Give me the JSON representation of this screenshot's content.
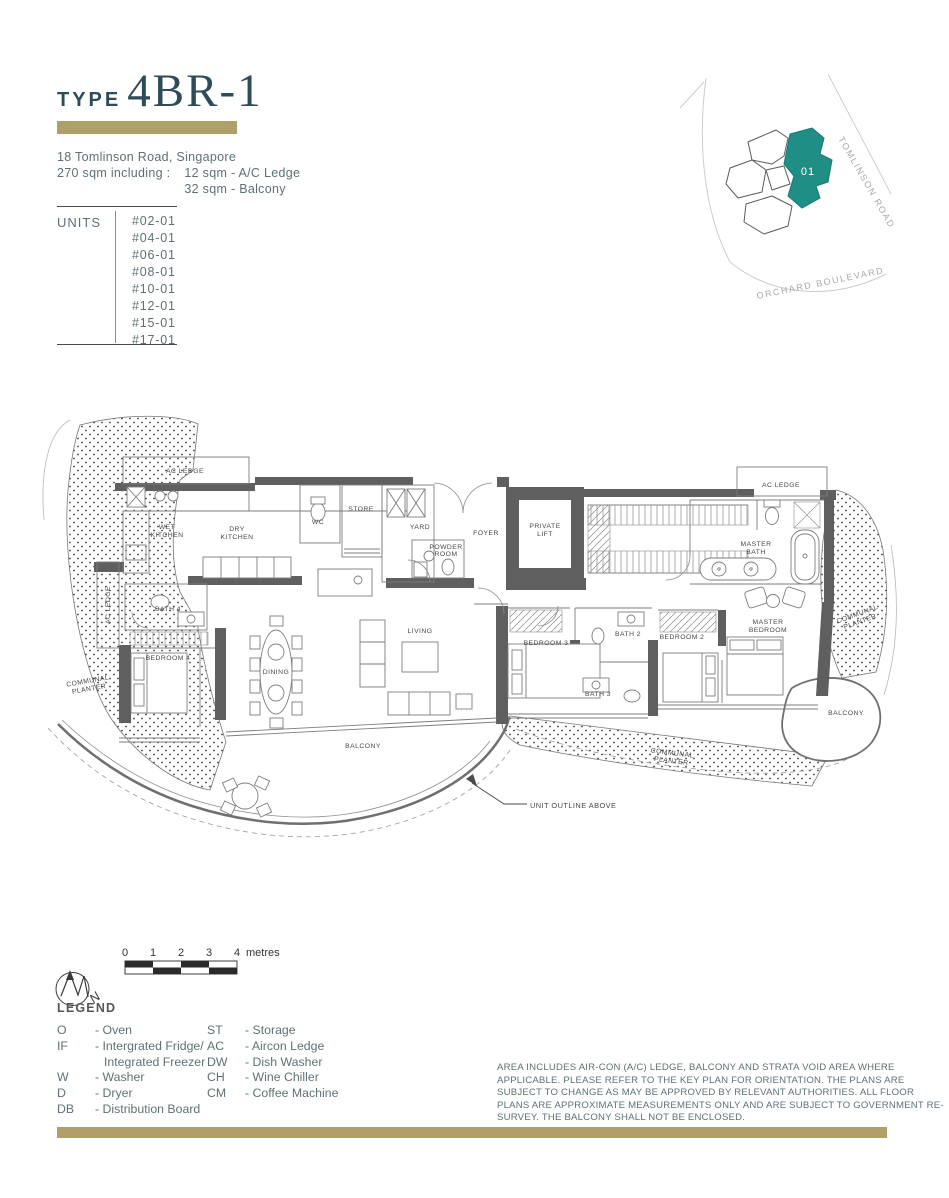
{
  "colors": {
    "accent_gold": "#af9f68",
    "title_teal": "#2e4b57",
    "keyplan_teal": "#1f8e85"
  },
  "header": {
    "type_label": "TYPE",
    "type_value": "4BR-1",
    "address": "18 Tomlinson Road, Singapore",
    "area_prefix": "270 sqm including :",
    "area_items": [
      "12 sqm - A/C Ledge",
      "32 sqm - Balcony"
    ]
  },
  "units": {
    "label": "UNITS",
    "list": [
      "#02-01",
      "#04-01",
      "#06-01",
      "#08-01",
      "#10-01",
      "#12-01",
      "#15-01",
      "#17-01"
    ]
  },
  "key_plan": {
    "unit_number": "01",
    "road_top": "TOMLINSON ROAD",
    "road_bottom": "ORCHARD BOULEVARD"
  },
  "floor_plan": {
    "labels": {
      "ac_ledge": "AC LEDGE",
      "wet_kitchen": [
        "WET",
        "KITCHEN"
      ],
      "dry_kitchen": [
        "DRY",
        "KITCHEN"
      ],
      "wc": "WC",
      "store": "STORE",
      "yard": "YARD",
      "powder_room": [
        "POWDER",
        "ROOM"
      ],
      "foyer": "FOYER",
      "private_lift": [
        "PRIVATE",
        "LIFT"
      ],
      "master_bath": [
        "MASTER",
        "BATH"
      ],
      "bath_2": "BATH 2",
      "bath_3": "BATH 3",
      "bath_4": "BATH 4",
      "bedroom_2": "BEDROOM 2",
      "bedroom_3": "BEDROOM 3",
      "bedroom_4": "BEDROOM 4",
      "master_bedroom": [
        "MASTER",
        "BEDROOM"
      ],
      "living": "LIVING",
      "dining": "DINING",
      "balcony": "BALCONY",
      "communal_planter": [
        "COMMUNAL",
        "PLANTER"
      ],
      "unit_outline": "UNIT OUTLINE ABOVE"
    }
  },
  "scale_bar": {
    "ticks": [
      "0",
      "1",
      "2",
      "3",
      "4"
    ],
    "unit": "metres",
    "north": "N"
  },
  "legend": {
    "title": "LEGEND",
    "col1": [
      {
        "abbr": "O",
        "term": "- Oven"
      },
      {
        "abbr": "IF",
        "term": "- Intergrated Fridge/",
        "term2": "Integrated Freezer"
      },
      {
        "abbr": "W",
        "term": "- Washer"
      },
      {
        "abbr": "D",
        "term": "- Dryer"
      },
      {
        "abbr": "DB",
        "term": "- Distribution Board"
      }
    ],
    "col2": [
      {
        "abbr": "ST",
        "term": "- Storage"
      },
      {
        "abbr": "AC",
        "term": "- Aircon Ledge"
      },
      {
        "abbr": "DW",
        "term": "- Dish Washer"
      },
      {
        "abbr": "CH",
        "term": "- Wine Chiller"
      },
      {
        "abbr": "CM",
        "term": "- Coffee Machine"
      }
    ]
  },
  "disclaimer": "AREA INCLUDES AIR-CON (A/C) LEDGE, BALCONY AND STRATA VOID AREA WHERE APPLICABLE.  PLEASE REFER TO THE KEY PLAN FOR ORIENTATION. THE PLANS ARE SUBJECT TO CHANGE AS MAY BE APPROVED BY RELEVANT AUTHORITIES. ALL FLOOR PLANS ARE APPROXIMATE MEASUREMENTS ONLY AND ARE SUBJECT TO GOVERNMENT RE-SURVEY. THE BALCONY SHALL NOT BE ENCLOSED."
}
